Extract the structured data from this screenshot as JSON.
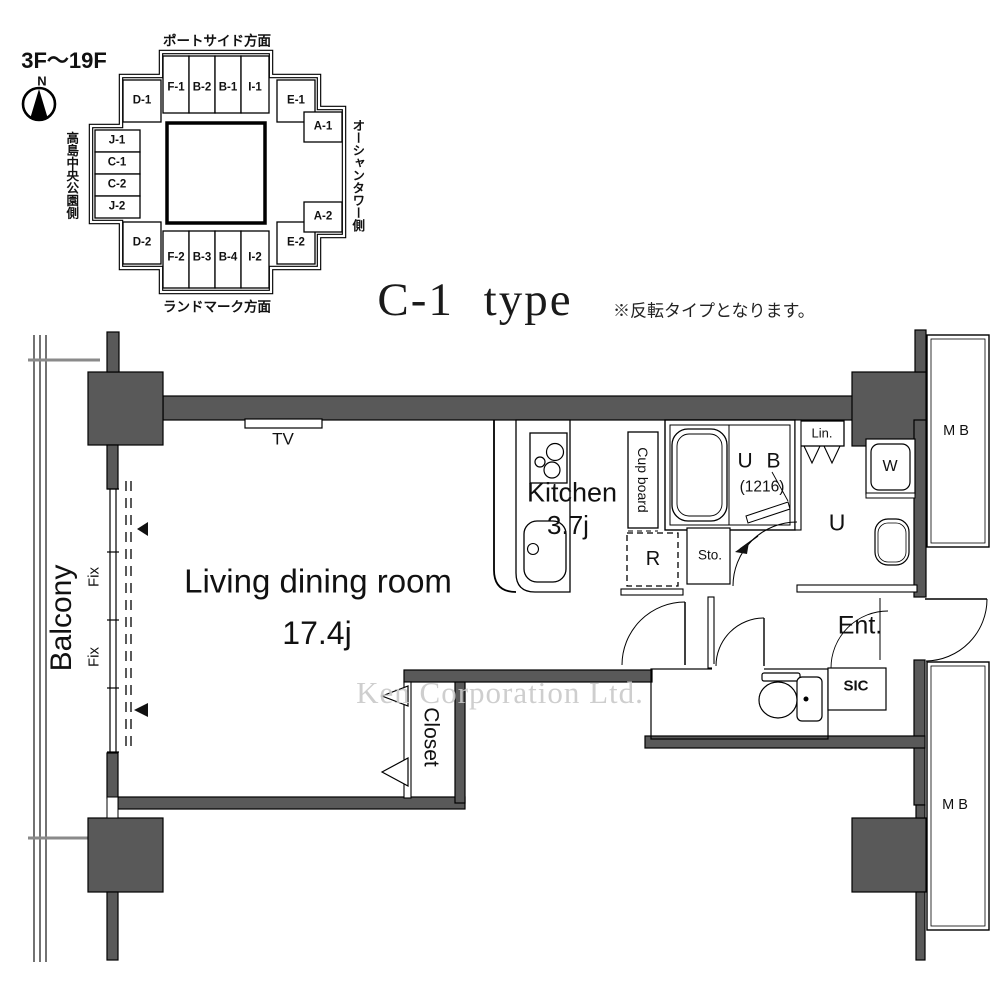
{
  "meta": {
    "floor_range": "3F〜19F",
    "compass_north": "N"
  },
  "locator": {
    "directions": {
      "top": "ポートサイド方面",
      "bottom": "ランドマーク方面",
      "left": "高島中央公園側",
      "right": "オーシャンタワー側"
    },
    "units": [
      "D-1",
      "F-1",
      "B-2",
      "B-1",
      "I-1",
      "E-1",
      "A-1",
      "J-1",
      "C-1",
      "C-2",
      "J-2",
      "D-2",
      "F-2",
      "B-3",
      "B-4",
      "I-2",
      "E-2",
      "A-2"
    ]
  },
  "title": {
    "main": "C-1 type",
    "note": "※反転タイプとなります。"
  },
  "plan": {
    "living": {
      "name": "Living dining room",
      "size": "17.4j"
    },
    "kitchen": {
      "name": "Kitchen",
      "size": "3.7j"
    },
    "balcony": "Balcony",
    "fix1": "Fix",
    "fix2": "Fix",
    "tv": "TV",
    "cupboard": "Cup board",
    "ub": {
      "name": "U B",
      "size": "(1216)"
    },
    "lin": "Lin.",
    "u": "U",
    "w": "W",
    "sto": "Sto.",
    "r": "R",
    "ent": "Ent.",
    "sic": "SIC",
    "closet": "Closet",
    "mb_top": "M B",
    "mb_bottom": "M B"
  },
  "watermark": "Ken Corporation Ltd.",
  "colors": {
    "wall": "#595959",
    "line": "#000000",
    "watermark": "#c9c9c9"
  }
}
